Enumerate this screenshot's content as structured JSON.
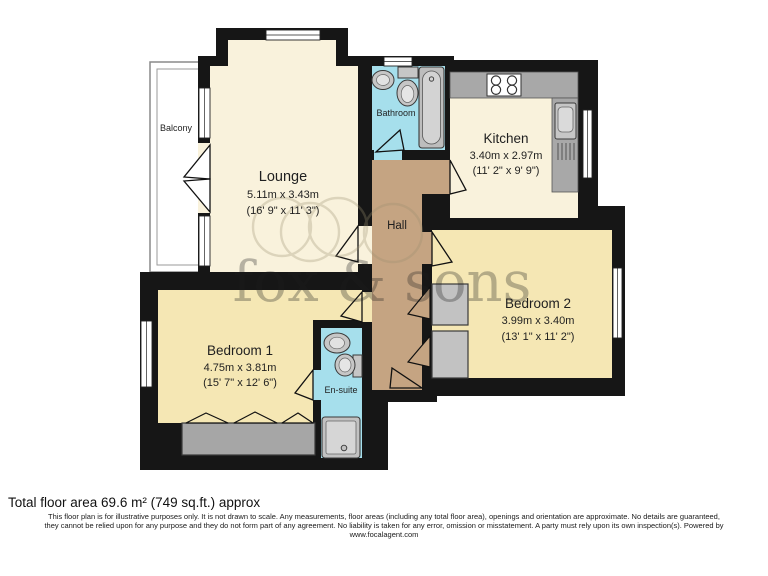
{
  "floorplan": {
    "watermark_text": "fox & sons",
    "rooms": {
      "lounge": {
        "name": "Lounge",
        "metric": "5.11m x 3.43m",
        "imperial": "(16' 9\" x 11' 3\")"
      },
      "kitchen": {
        "name": "Kitchen",
        "metric": "3.40m x 2.97m",
        "imperial": "(11' 2\" x 9' 9\")"
      },
      "bedroom1": {
        "name": "Bedroom 1",
        "metric": "4.75m x 3.81m",
        "imperial": "(15' 7\" x 12' 6\")"
      },
      "bedroom2": {
        "name": "Bedroom 2",
        "metric": "3.99m x 3.40m",
        "imperial": "(13' 1\" x 11' 2\")"
      },
      "bathroom": {
        "name": "Bathroom"
      },
      "ensuite": {
        "name": "En-suite"
      },
      "hall": {
        "name": "Hall"
      },
      "balcony": {
        "name": "Balcony"
      }
    },
    "colors": {
      "wall": "#161616",
      "lounge_kitchen_fill": "#F9F2DC",
      "bedroom_fill": "#F5E7B4",
      "hall_fill": "#C5A482",
      "wet_room_fill": "#A6DFEC",
      "furniture_gray": "#A8A8A8",
      "watermark": "#9C9071"
    }
  },
  "footer": {
    "total_area": "Total floor area 69.6 m² (749 sq.ft.) approx",
    "disclaimer_lines": [
      "This floor plan is for illustrative purposes only. It is not drawn to scale. Any measurements, floor areas (including any total floor area), openings and orientation are approximate. No details are guaranteed,",
      "they cannot be relied upon for any purpose and they do not form part of any agreement. No liability is taken for any error, omission or misstatement. A party must rely upon its own inspection(s). Powered by",
      "www.focalagent.com"
    ]
  }
}
